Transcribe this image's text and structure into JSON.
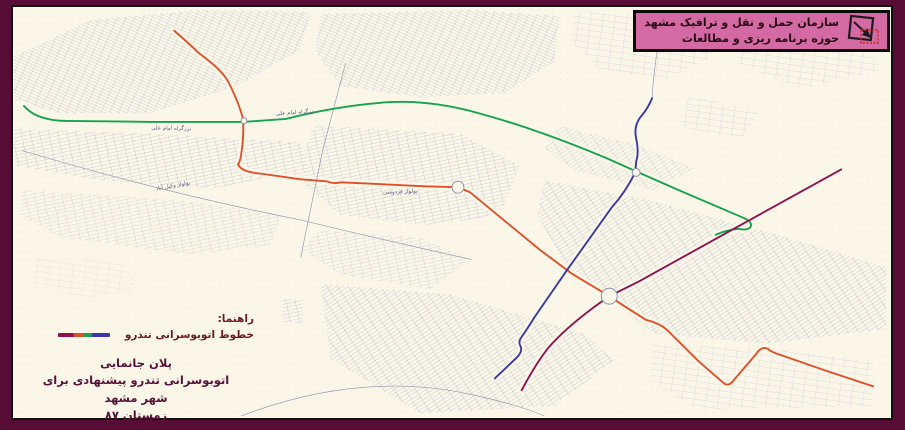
{
  "window": {
    "width": 905,
    "height": 430
  },
  "header": {
    "line1": "سازمان حمل و نقل و ترافیک مشهد",
    "line2": "حوزه برنامه ریزی و مطالعات",
    "logo": "square-diagonal-arrow-logo"
  },
  "legend": {
    "title": "راهنما:",
    "item_label": "خطوط اتوبوسرانی تندرو",
    "sample_segments": [
      "#8f124f",
      "#e04f2c",
      "#17a24f",
      "#3838a8"
    ]
  },
  "caption": {
    "line1": "پلان جانمایی",
    "line2": "اتوبوسرانی تندرو پیشنهادی برای شهر مشهد",
    "line3": "زمستان ۸۷"
  },
  "colors": {
    "frame": "#570c36",
    "map_background": "#faf7e9",
    "header_box": "#d46aa4",
    "street_grid": "#a9a9bf",
    "legend_text": "#6d1824",
    "caption_text": "#571036",
    "junction_stroke": "#8f8fa8"
  },
  "map": {
    "routes": [
      {
        "name": "brt-route-red",
        "color": "#e04f2c",
        "path": "M173,29 C181,36 190,44 197,51 C210,61 222,70 228,82 C234,94 239,106 242,118 C243,131 242,140 241,148 C240,157 239,162 237,164 C240,170 248,172 258,173 L300,179 L326,181 Q333,184 340,182 L425,186 L458,187 L470,192 L540,250 L572,274 L610,297 L625,307 L647,321 Q660,324 668,331 L700,363 L724,384 Q729,389 734,383 L757,356 Q763,347 769,350 Q772,353 781,356 L830,373 L875,388"
      },
      {
        "name": "brt-route-green",
        "color": "#17a24f",
        "path": "M22,105 Q30,114 42,117 Q52,120 65,120 L150,121 L243,121 L285,118 Q340,104 390,101 Q432,99 478,112 Q540,129 608,158 L637,171 L680,190 L745,218 Q754,222 752,227 Q749,231 740,229 Q728,230 717,235"
      },
      {
        "name": "brt-route-blue",
        "color": "#3838a8",
        "path": "M653,97 Q649,107 643,114 Q634,124 637,138 Q640,152 637,161 L636,172 Q627,191 612,208 L568,270 Q548,299 535,318 Q527,331 522,338 Q518,343 521,348 Q523,353 517,359 L495,380"
      },
      {
        "name": "brt-route-purple",
        "color": "#8f124f",
        "path": "M843,169 L753,219 L640,282 Q620,292 610,297 L596,307 Q565,330 548,350 Q535,367 522,392"
      }
    ],
    "junctions": [
      {
        "x": 458,
        "y": 187,
        "r": 6
      },
      {
        "x": 610,
        "y": 297,
        "r": 8
      },
      {
        "x": 637,
        "y": 172,
        "r": 4
      },
      {
        "x": 243,
        "y": 120,
        "r": 3
      }
    ],
    "street_labels": [
      {
        "text": "بزرگراه امام علی",
        "x": 170,
        "y": 129,
        "angle": 1
      },
      {
        "text": "بزرگراه امام علی",
        "x": 295,
        "y": 113,
        "angle": -4
      },
      {
        "text": "بولوار وکیل آباد",
        "x": 172,
        "y": 187,
        "angle": -10
      },
      {
        "text": "بولوار فردوسی",
        "x": 400,
        "y": 193,
        "angle": -2
      }
    ]
  }
}
